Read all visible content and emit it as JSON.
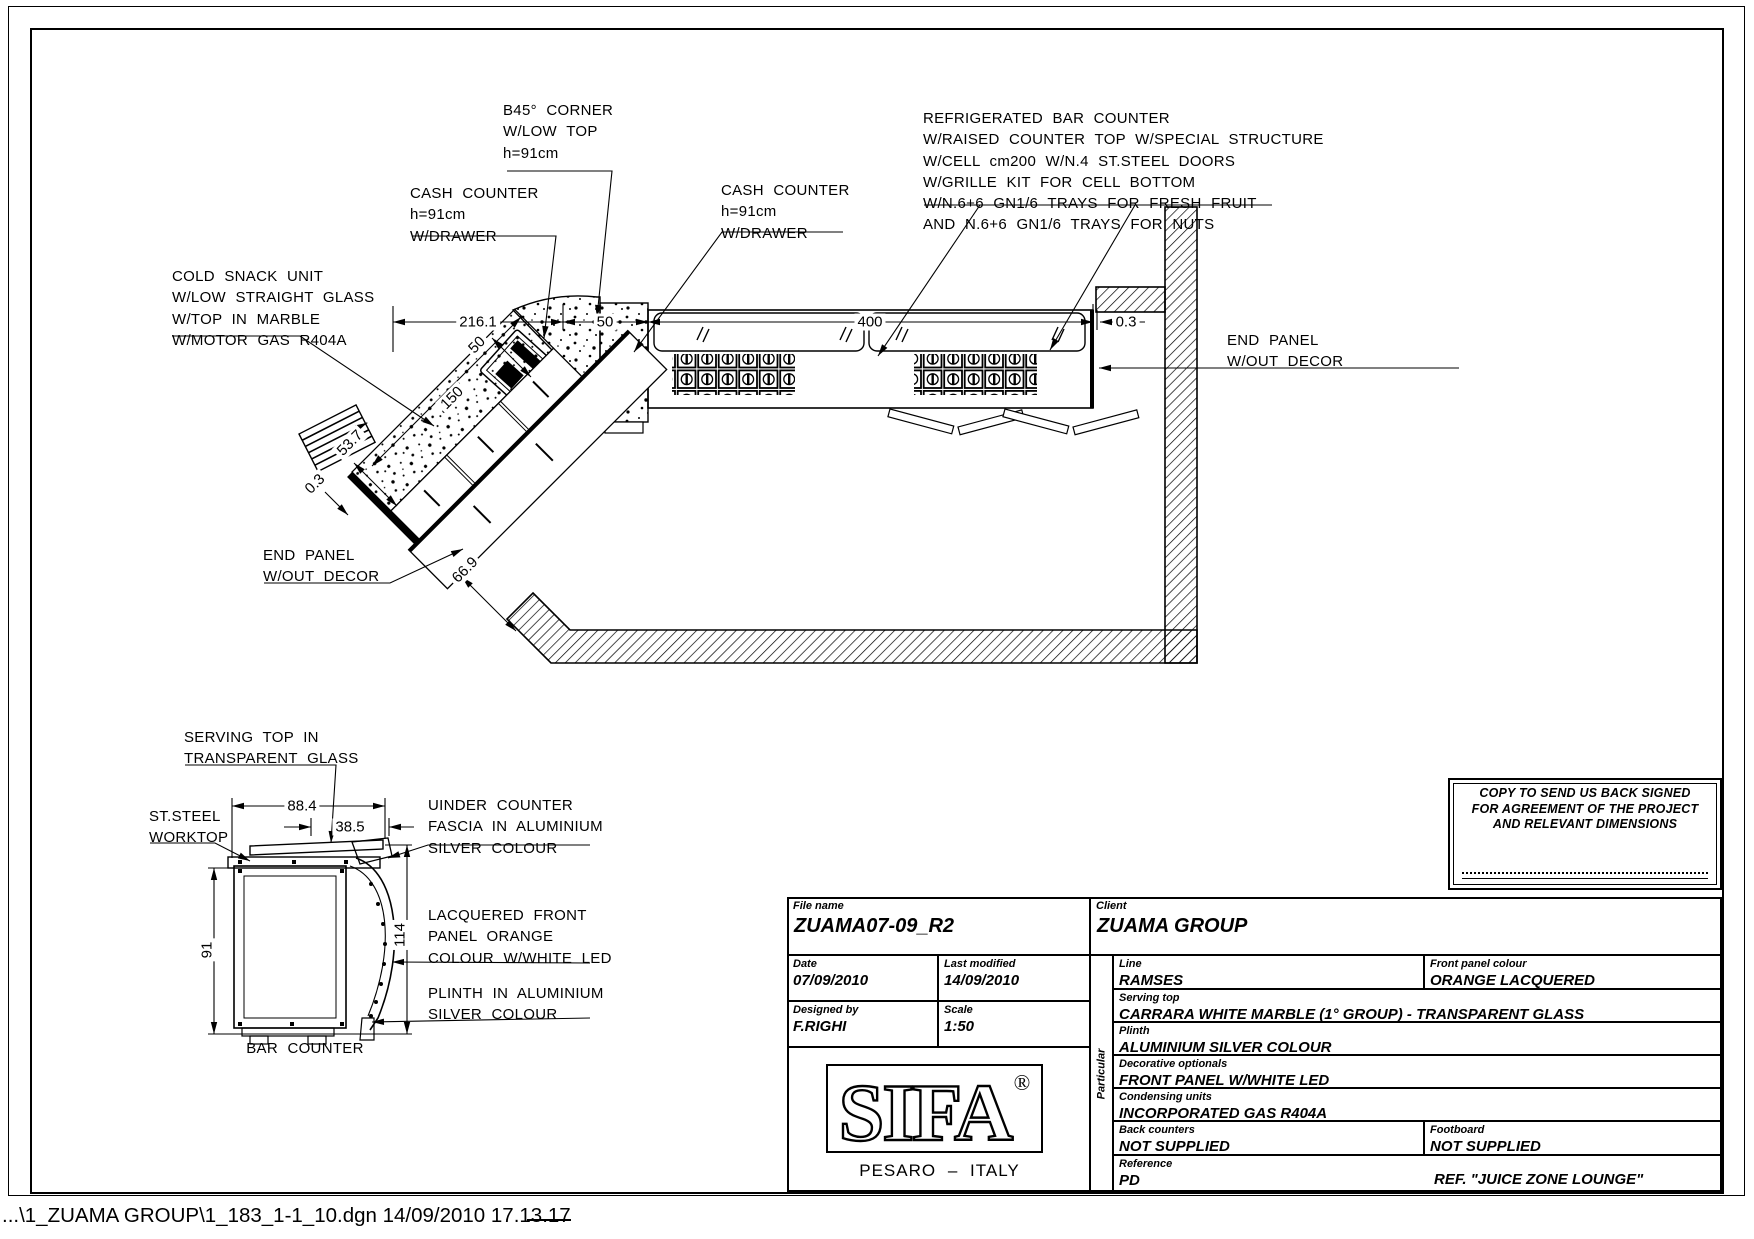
{
  "plan": {
    "ann": {
      "b45": "B45° CORNER\nW/LOW TOP\nh=91cm",
      "cash1": "CASH COUNTER\nh=91cm\nW/DRAWER",
      "cash2": "CASH COUNTER\nh=91cm\nW/DRAWER",
      "fridge": "REFRIGERATED BAR COUNTER\nW/RAISED COUNTER TOP W/SPECIAL STRUCTURE\nW/CELL cm200 W/N.4 ST.STEEL DOORS\nW/GRILLE KIT FOR CELL BOTTOM\nW/N.6+6 GN1/6 TRAYS FOR FRESH FRUIT\nAND N.6+6 GN1/6 TRAYS FOR NUTS",
      "cold_snack": "COLD SNACK UNIT\nW/LOW STRAIGHT GLASS\nW/TOP IN MARBLE\nW/MOTOR GAS R404A",
      "end_panel_right": "END PANEL\nW/OUT DECOR",
      "end_panel_left": "END PANEL\nW/OUT DECOR"
    },
    "dim": {
      "w216": "216.1",
      "w50": "50",
      "w400": "400",
      "w03": "0.3",
      "L150": "150",
      "L50": "50",
      "L537": "53.7",
      "L03": "0.3",
      "L669": "66.9"
    }
  },
  "section": {
    "ann": {
      "serving_top": "SERVING TOP IN\nTRANSPARENT GLASS",
      "st_steel": "ST.STEEL\nWORKTOP",
      "under_counter": "UINDER COUNTER\nFASCIA IN ALUMINIUM\nSILVER COLOUR",
      "lacquered": "LACQUERED FRONT\nPANEL ORANGE\nCOLOUR W/WHITE LED",
      "plinth": "PLINTH IN ALUMINIUM\nSILVER COLOUR",
      "bar_counter": "BAR COUNTER"
    },
    "dim": {
      "w884": "88.4",
      "w385": "38.5",
      "h91": "91",
      "h114": "114"
    }
  },
  "titleblock": {
    "file_name_label": "File name",
    "file_name": "ZUAMA07-09_R2",
    "client_label": "Client",
    "client": "ZUAMA GROUP",
    "date_label": "Date",
    "date": "07/09/2010",
    "modified_label": "Last modified",
    "modified": "14/09/2010",
    "designed_label": "Designed by",
    "designed": "F.RIGHI",
    "scale_label": "Scale",
    "scale": "1:50",
    "particular_label": "Particular",
    "line_label": "Line",
    "line": "RAMSES",
    "front_panel_label": "Front panel colour",
    "front_panel": "ORANGE LACQUERED",
    "serving_label": "Serving top",
    "serving": "CARRARA WHITE MARBLE (1° GROUP) - TRANSPARENT GLASS",
    "plinth_label": "Plinth",
    "plinth": "ALUMINIUM SILVER COLOUR",
    "decorative_label": "Decorative optionals",
    "decorative": "FRONT PANEL W/WHITE LED",
    "condensing_label": "Condensing units",
    "condensing": "INCORPORATED GAS R404A",
    "back_label": "Back counters",
    "back": "NOT SUPPLIED",
    "foot_label": "Footboard",
    "foot": "NOT SUPPLIED",
    "reference_label": "Reference",
    "reference": "PD",
    "reference_note": "REF. \"JUICE ZONE LOUNGE\""
  },
  "copy_note": {
    "text": "COPY TO SEND US BACK SIGNED\nFOR AGREEMENT OF THE PROJECT\nAND RELEVANT DIMENSIONS"
  },
  "logo": {
    "name": "SIFA",
    "reg": "®",
    "city": "PESARO – ITALY"
  },
  "status": {
    "text": "...\\1_ZUAMA GROUP\\1_183_1-1_10.dgn  14/09/2010 17.13.17"
  }
}
